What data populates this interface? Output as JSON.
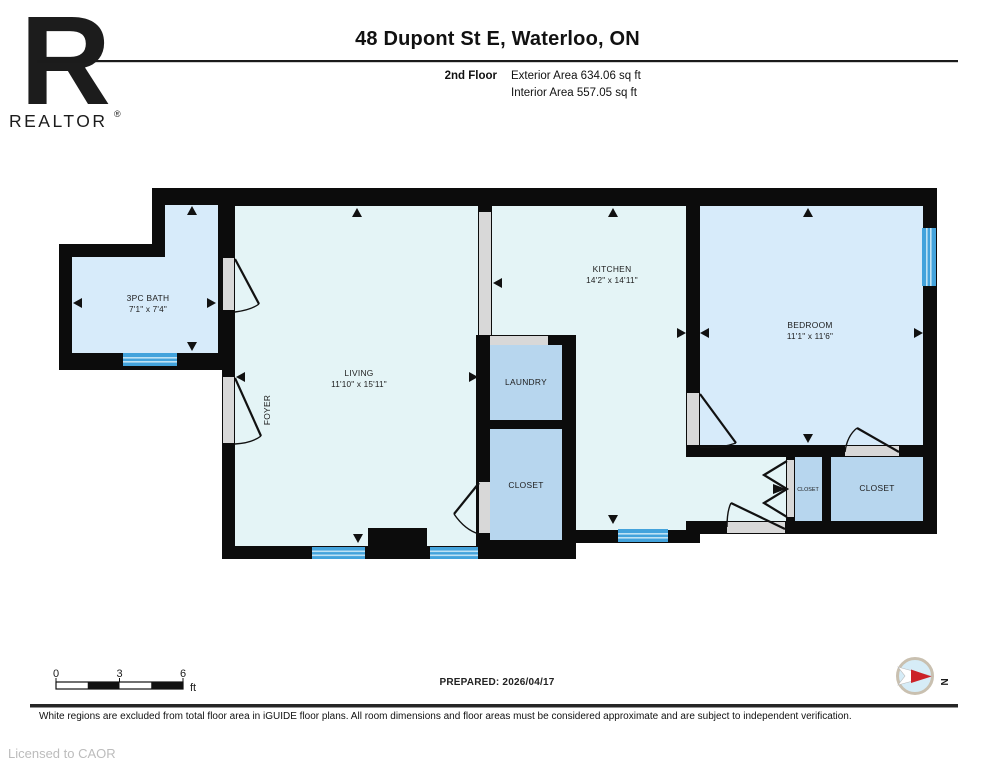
{
  "header": {
    "logo_letter": "R",
    "logo_wordmark": "REALTOR",
    "logo_registered": "®",
    "title": "48 Dupont St E, Waterloo, ON",
    "floor_label": "2nd Floor",
    "exterior_area": "Exterior Area 634.06 sq ft",
    "interior_area": "Interior Area 557.05 sq ft"
  },
  "plan": {
    "rooms": {
      "bath": {
        "name": "3PC BATH",
        "dims": "7'1\" x 7'4\""
      },
      "living": {
        "name": "LIVING",
        "dims": "11'10\" x 15'11\""
      },
      "foyer": {
        "name": "FOYER"
      },
      "kitchen": {
        "name": "KITCHEN",
        "dims": "14'2\" x 14'11\""
      },
      "laundry": {
        "name": "LAUNDRY"
      },
      "hall_closet": {
        "name": "CLOSET"
      },
      "bedroom": {
        "name": "BEDROOM",
        "dims": "11'1\" x 11'6\""
      },
      "small_closet": {
        "name": "CLOSET"
      },
      "bedroom_closet": {
        "name": "CLOSET"
      }
    },
    "colors": {
      "room_cyan": "#e4f4f6",
      "room_blue": "#d7ebfa",
      "room_medium_blue": "#b7d6ee",
      "wall": "#0c0c0c",
      "opening": "#d8d8d8",
      "window_blue": "#43a3dc",
      "window_stripe": "#bfe2f4"
    }
  },
  "footer": {
    "scale": {
      "t0": "0",
      "t3": "3",
      "t6": "6",
      "unit": "ft"
    },
    "prepared": "PREPARED: 2026/04/17",
    "compass": "N",
    "disclaimer": "White regions are excluded from total floor area in iGUIDE floor plans. All room dimensions and floor areas must be considered approximate and are subject to independent verification.",
    "license": "Licensed to CAOR"
  }
}
